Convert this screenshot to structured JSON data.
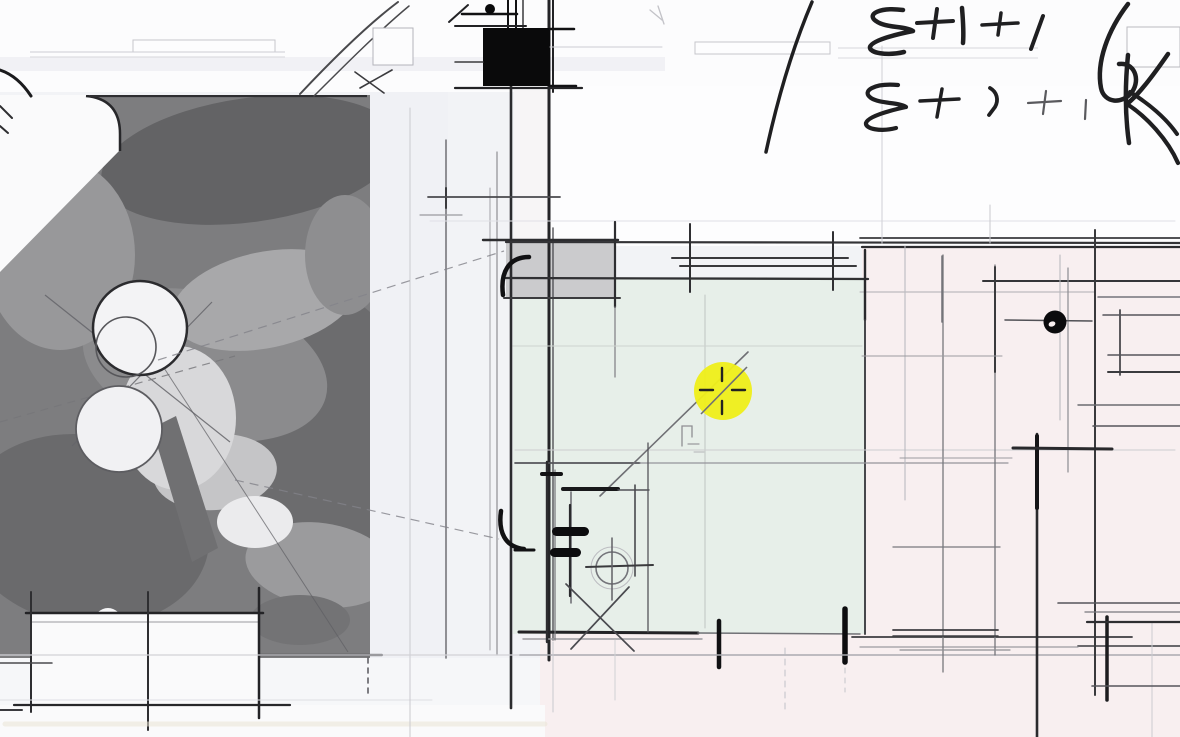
{
  "annotations": {
    "handwriting_line1": "3+1+1",
    "handwriting_line2": "3+2+1"
  },
  "cursor": {
    "x": 723,
    "y": 391,
    "radius": 29,
    "glyph": "crosshair"
  },
  "colors": {
    "page_bg": "#f2f3f6",
    "paper_white": "#fcfcfd",
    "room_green": "#e7efe9",
    "room_pink": "#f8eff0",
    "texture_base": "#7d7d7f",
    "wall_fill_gray": "#cbcbcd",
    "wall_fill_black": "#0a0a0b",
    "ink": "#1f1f21",
    "pencil": "#55555a",
    "faint_line": "#c9c9ce",
    "highlight_yellow": "#efee1b",
    "crosshair": "#222222",
    "cream_band": "#eae5d6"
  }
}
